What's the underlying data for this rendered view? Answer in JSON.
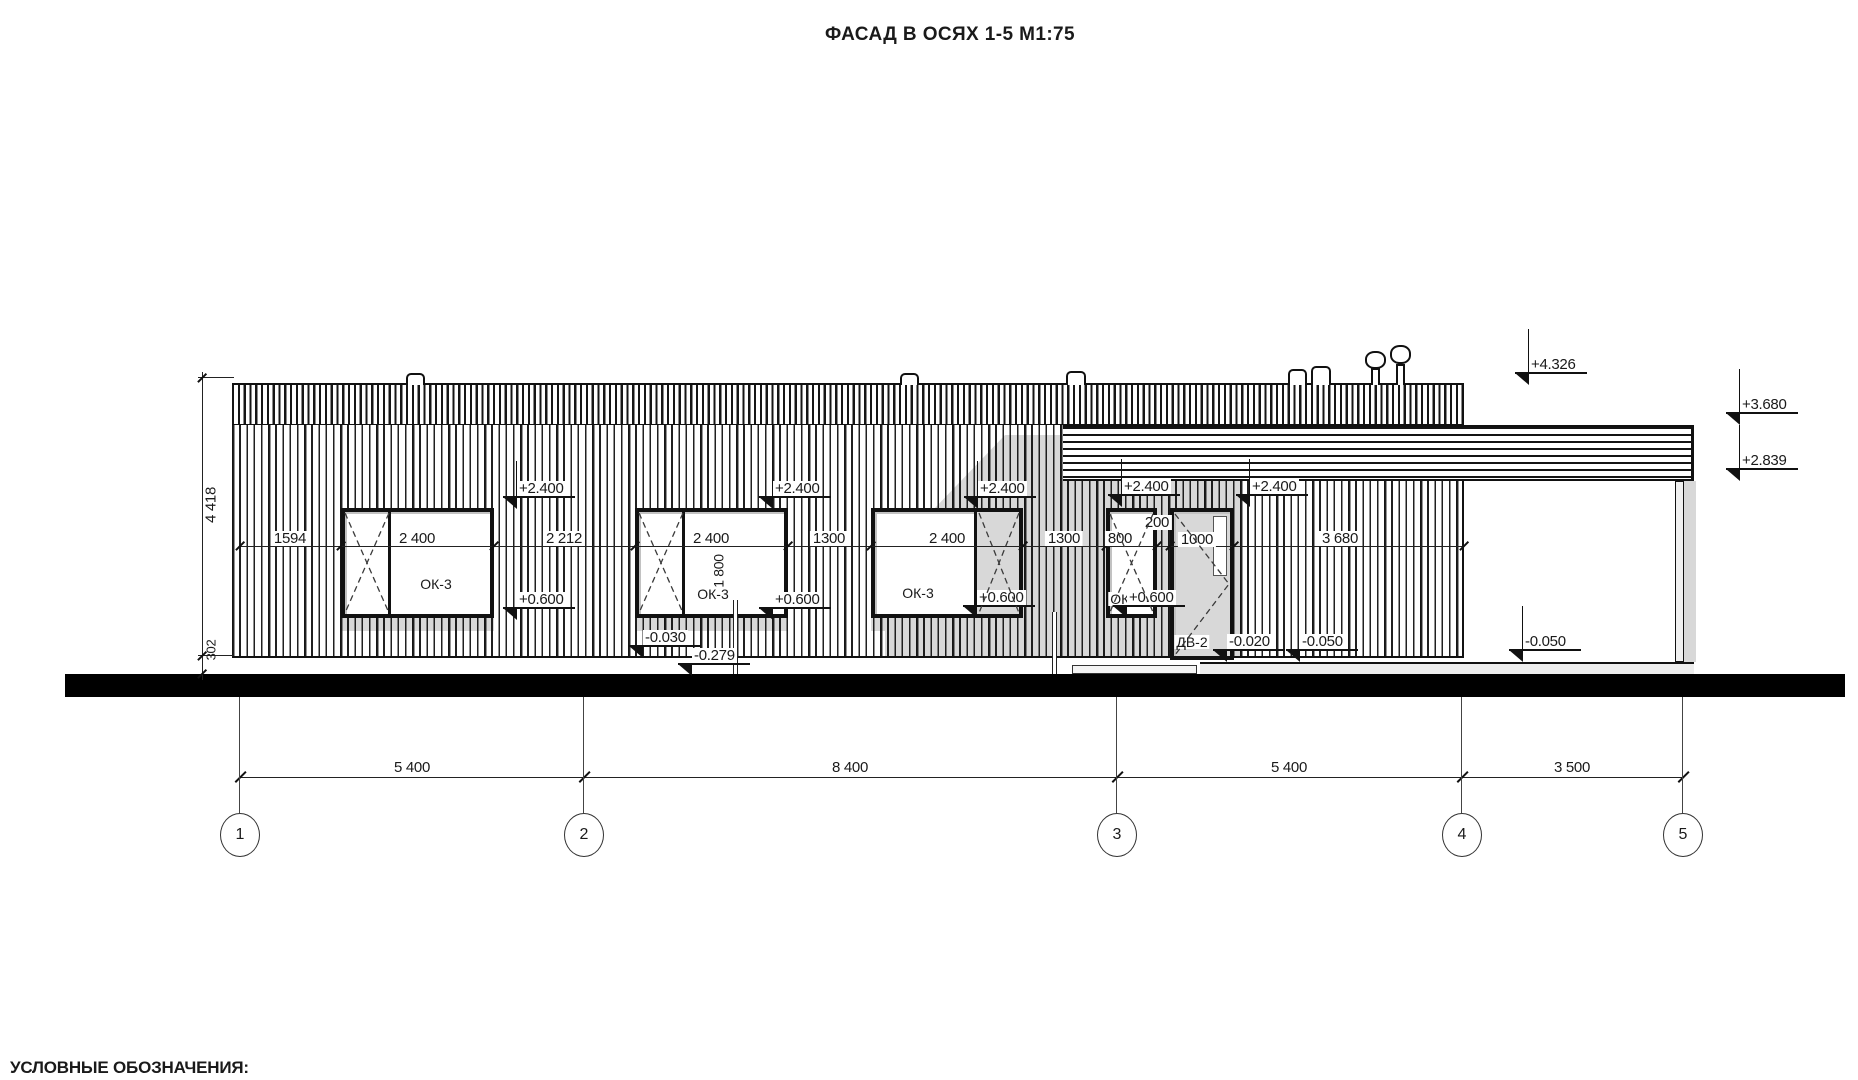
{
  "title": "ФАСАД В ОСЯХ 1-5 М1:75",
  "legend_heading": "УСЛОВНЫЕ ОБОЗНАЧЕНИЯ:",
  "axes": {
    "labels": [
      "1",
      "2",
      "3",
      "4",
      "5"
    ],
    "spacing_dims": [
      "5 400",
      "8 400",
      "5 400",
      "3 500"
    ]
  },
  "horizontal_dims": [
    "1594",
    "2 400",
    "2 212",
    "2 400",
    "1300",
    "2 400",
    "1300",
    "800",
    "200",
    "1000",
    "3 680"
  ],
  "vertical_dims": {
    "facade_height": "4 418",
    "plinth_height": "302",
    "window_height": "1 800"
  },
  "openings": {
    "window1": "ОК-3",
    "window2": "ОК-3",
    "window3": "ОК-3",
    "window4": "ОК-7",
    "door": "ДВ-2"
  },
  "elevation_marks": {
    "roof_top": "+4.326",
    "canopy_top": "+3.680",
    "canopy_bottom": "+2.839",
    "lintel1": "+2.400",
    "lintel2": "+2.400",
    "lintel3": "+2.400",
    "lintel4": "+2.400",
    "lintel5": "+2.400",
    "sill1": "+0.600",
    "sill2": "+0.600",
    "sill3": "+0.600",
    "sill4": "+0.600",
    "base1": "-0.030",
    "base2": "-0.279",
    "porch1": "-0.020",
    "porch2": "-0.050",
    "terrace": "-0.050"
  },
  "colors": {
    "line": "#1a1a1a",
    "shadow": "#d8d8d8",
    "ground": "#000000"
  }
}
